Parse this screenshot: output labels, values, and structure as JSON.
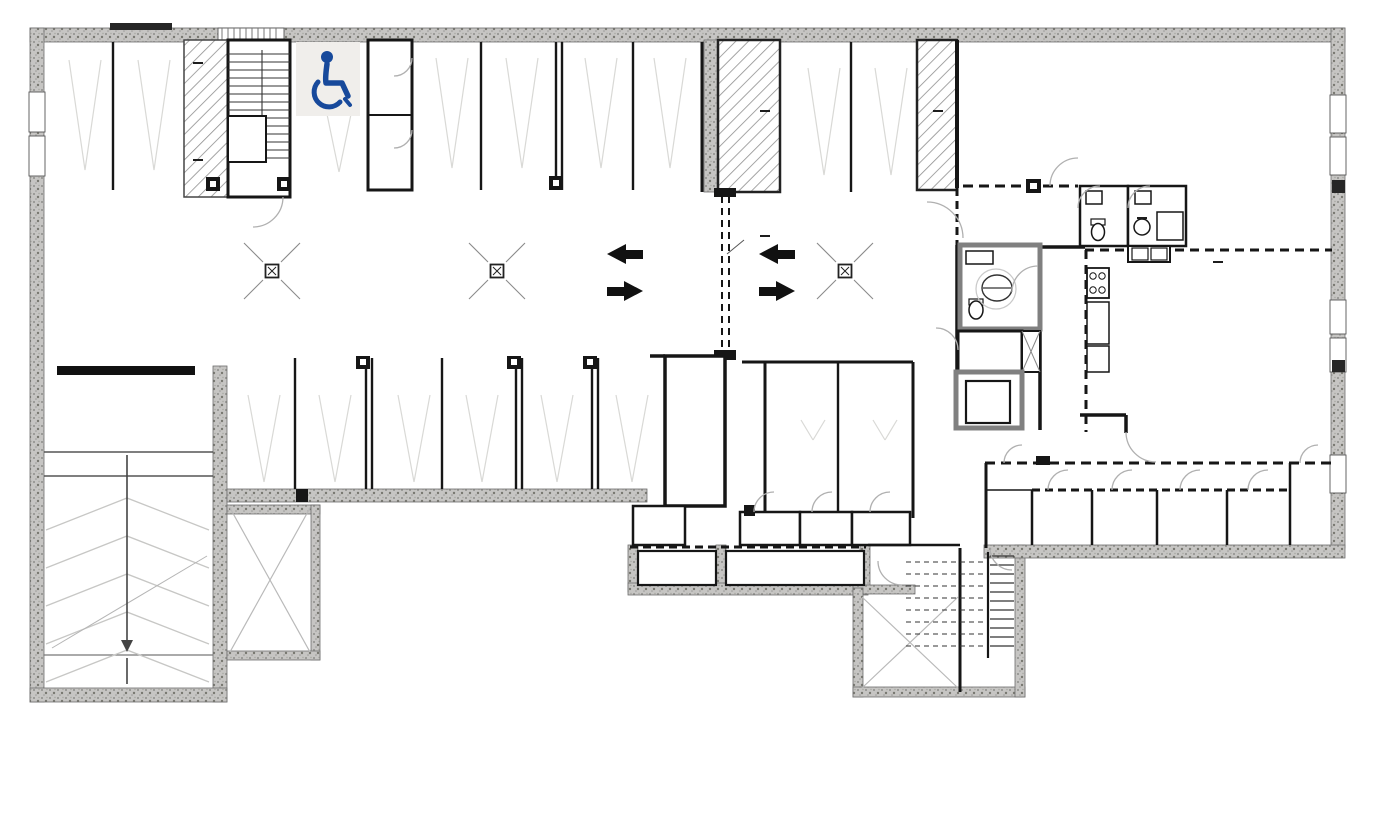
{
  "parking": {
    "top": [
      {
        "num": "1",
        "reserved": "RESERVED\nBY 101"
      },
      {
        "num": "2",
        "reserved": "RESERVE\nBY 307"
      },
      {
        "num": "3",
        "reserved": "RESERVED\nBY 306"
      },
      {
        "num": "4",
        "reserved": "RESERVED\nBY 212"
      },
      {
        "num": "5",
        "reserved": "RESERVED\nBY 205"
      },
      {
        "num": "6",
        "reserved": "RESERVED\nBY 106"
      },
      {
        "num": "7",
        "reserved": "RESERVED\nBY 108"
      },
      {
        "num": "8",
        "reserved": "RESERVED\nBY 302"
      },
      {
        "num": "9",
        "reserved": "RESERVED\nBY 312"
      }
    ],
    "bottom": [
      {
        "num": "17",
        "reserved": "RESERVED\nBY 201"
      },
      {
        "num": "16",
        "reserved": "RESERVED\nBY 202"
      },
      {
        "num": "15",
        "reserved": "RESERVED\nBY 110"
      },
      {
        "num": "14",
        "reserved": "RESERVED\nBY 107"
      },
      {
        "num": "13",
        "reserved": "RESERVED\nBY 209"
      },
      {
        "num": "12",
        "reserved": "RESERVED\nBY 208"
      },
      {
        "num": "11",
        "reserved": "RESERVED\nBY 210"
      },
      {
        "num": "10",
        "reserved": "RESERVED\nBY 109"
      }
    ]
  },
  "storages": {
    "s1b": "1 B",
    "s2b": "2 B",
    "s3b": "3 B",
    "s4b": "4 B",
    "s5b": "5 B",
    "s6b": "6 B",
    "s7b": "7 B",
    "s8b": "8 B",
    "s9b": "9 B",
    "s10b": "10 B",
    "s11b": "11 B",
    "s12b": "12 B",
    "s13b": "13 B",
    "s14b": "14 B"
  },
  "rooms": {
    "gym": "Gym\nExercise Room",
    "kitchen": "Kitchen",
    "party": "Party room\nCommunity room\nMulti purpose room",
    "elev": "ELEV",
    "elev_mech": "Elev\nmech rm",
    "elec": "Elec rm",
    "mech": "Mech rm",
    "water": "Water meter"
  },
  "fire_ratings": {
    "stair_top": "1hr",
    "stair_bottom": "1hr",
    "shaft_left": "2hrs",
    "shaft_right": "2hrs",
    "center": "1.5hrs",
    "gym_bath": "1hr",
    "kitchen": "1hr"
  },
  "ref_bubble": {
    "number": "5",
    "sheet": "A800"
  },
  "storage_sizes": {
    "title": "Storage Sizes",
    "items": [
      "9 - (8’ 10” x 4’)",
      "8 - (7’ 8.5” x 4’ 5”)",
      "7 - (7’ 8.5” x 4’ 5”)",
      "6 - (8’ 6.5” x 4’ 5”)",
      "5 - (8’ 6.5” x 4’ 5”)",
      "14 - (4’ x 8’ 8.5”)"
    ]
  },
  "note": {
    "text": "NOTE: Storages for parking: 15, 16 & 17\n          are on the main floor\n          See (Main floor storage plan)"
  },
  "address": {
    "text": "975 N Russell"
  },
  "icons": {
    "accessible_parking": "wheelchair-icon"
  },
  "colors": {
    "accessible_blue": "#17499b",
    "wall": "#161616",
    "concrete": "#c3c3c1"
  }
}
